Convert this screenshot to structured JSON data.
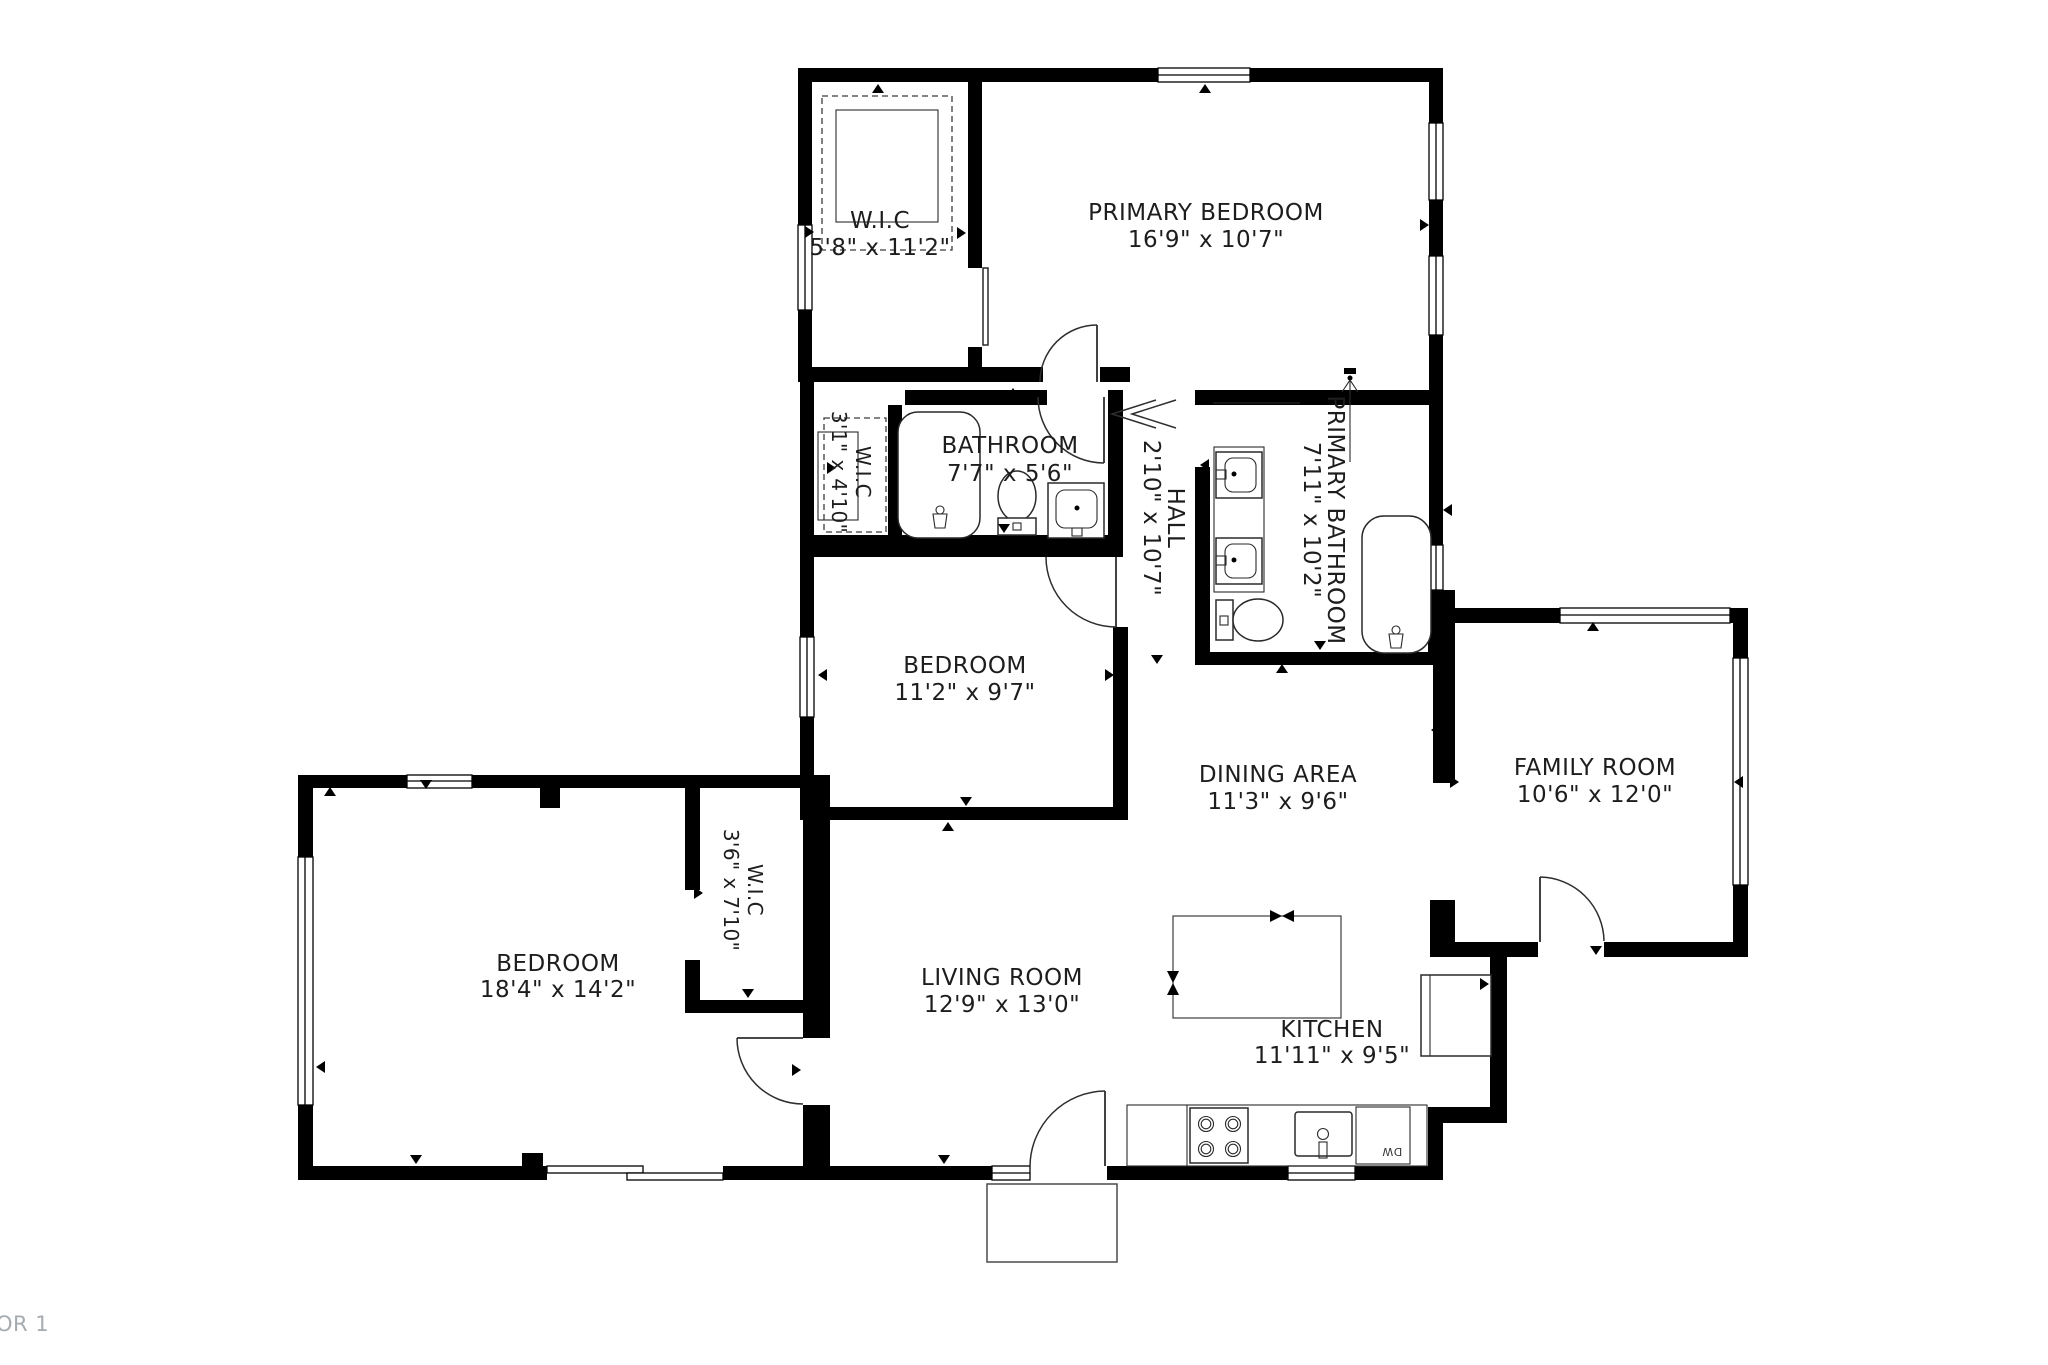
{
  "footer": {
    "floor_label": "OR 1"
  },
  "rooms": [
    {
      "id": "wic-top",
      "name": "W.I.C",
      "dims": "5'8\" x 11'2\"",
      "orientation": "horizontal"
    },
    {
      "id": "primary-bedroom",
      "name": "PRIMARY BEDROOM",
      "dims": "16'9\" x 10'7\"",
      "orientation": "horizontal"
    },
    {
      "id": "wic-small",
      "name": "W.I.C",
      "dims": "3'1\" x 4'10\"",
      "orientation": "vertical"
    },
    {
      "id": "bathroom",
      "name": "BATHROOM",
      "dims": "7'7\" x 5'6\"",
      "orientation": "horizontal"
    },
    {
      "id": "hall",
      "name": "HALL",
      "dims": "2'10\" x 10'7\"",
      "orientation": "vertical"
    },
    {
      "id": "primary-bathroom",
      "name": "PRIMARY BATHROOM",
      "dims": "7'11\" x 10'2\"",
      "orientation": "vertical"
    },
    {
      "id": "bedroom-middle",
      "name": "BEDROOM",
      "dims": "11'2\" x 9'7\"",
      "orientation": "horizontal"
    },
    {
      "id": "dining-area",
      "name": "DINING AREA",
      "dims": "11'3\" x 9'6\"",
      "orientation": "horizontal"
    },
    {
      "id": "family-room",
      "name": "FAMILY ROOM",
      "dims": "10'6\" x 12'0\"",
      "orientation": "horizontal"
    },
    {
      "id": "bedroom-large",
      "name": "BEDROOM",
      "dims": "18'4\" x 14'2\"",
      "orientation": "horizontal"
    },
    {
      "id": "wic-lower",
      "name": "W.I.C",
      "dims": "3'6\" x 7'10\"",
      "orientation": "vertical"
    },
    {
      "id": "living-room",
      "name": "LIVING ROOM",
      "dims": "12'9\" x 13'0\"",
      "orientation": "horizontal"
    },
    {
      "id": "kitchen",
      "name": "KITCHEN",
      "dims": "11'11\" x 9'5\"",
      "orientation": "horizontal"
    }
  ],
  "appliances": {
    "dishwasher": "DW"
  },
  "colors": {
    "wall": "#000000",
    "label_text": "#1d1d1d",
    "muted_text": "#a6abb0"
  }
}
